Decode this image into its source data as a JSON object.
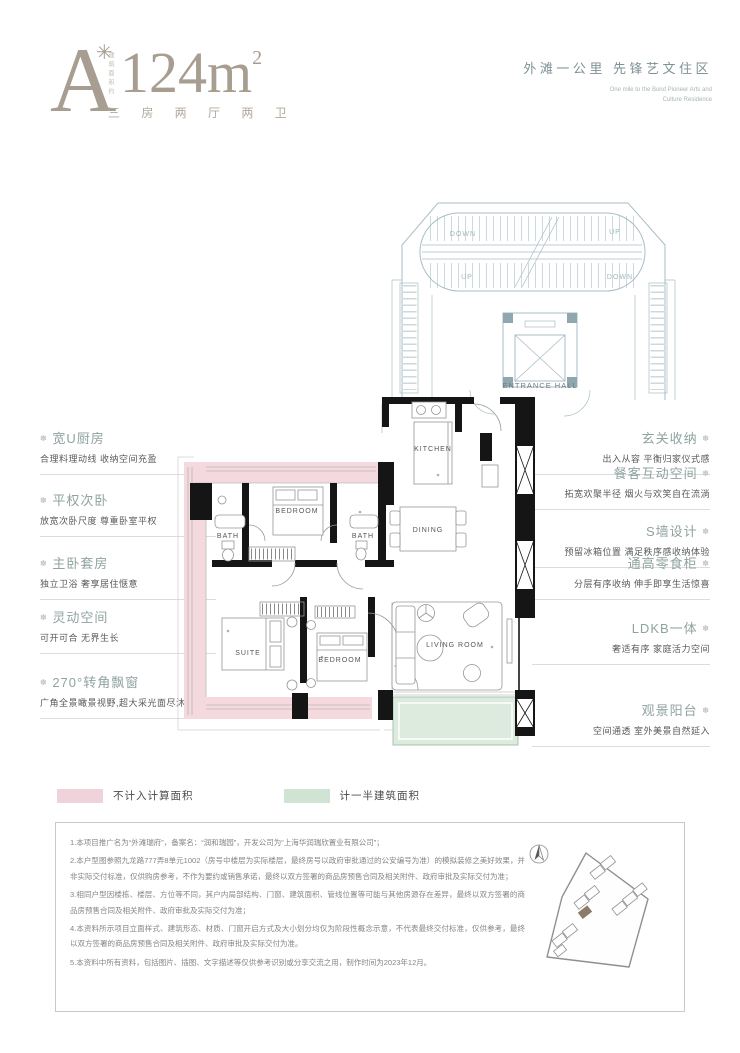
{
  "header": {
    "plan_letter": "A",
    "plan_star": "✳",
    "area_vertical_label": "建筑面积约",
    "area_value": "124m",
    "area_sup": "2",
    "layout_spec": "三 房 两 厅 两 卫",
    "tagline_cn": "外滩一公里  先锋艺文住区",
    "tagline_en_line1": "One mile to the Bund Pioneer Arts and",
    "tagline_en_line2": "Culture Residence"
  },
  "annotations": {
    "bullet": "✽",
    "left": [
      {
        "title": "宽U厨房",
        "desc": "合理料理动线 收纳空间充盈"
      },
      {
        "title": "平权次卧",
        "desc": "放宽次卧尺度 尊重卧室平权"
      },
      {
        "title": "主卧套房",
        "desc": "独立卫浴 奢享居住惬意"
      },
      {
        "title": "灵动空间",
        "desc": "可开可合 无界生长"
      },
      {
        "title": "270°转角飘窗",
        "desc": "广角全景瞰景视野,超大采光面尽沐阳光"
      }
    ],
    "right": [
      {
        "title": "玄关收纳",
        "desc": "出入从容 平衡归家仪式感"
      },
      {
        "title": "餐客互动空间",
        "desc": "拓宽欢聚半径 烟火与欢笑自在流淌"
      },
      {
        "title": "S墙设计",
        "desc": "预留冰箱位置 满足秩序感收纳体验"
      },
      {
        "title": "通高零食柜",
        "desc": "分层有序收纳 伸手即享生活惊喜"
      },
      {
        "title": "LDKB一体",
        "desc": "奢适有序 家庭活力空间"
      },
      {
        "title": "观景阳台",
        "desc": "空间通透 室外美景自然延入"
      }
    ]
  },
  "plan": {
    "rooms": {
      "kitchen": "KITCHEN",
      "bath": "BATH",
      "dining": "DINING",
      "bedroom": "BEDROOM",
      "suite": "SUITE",
      "living": "LIVING ROOM",
      "entrance_hall": "ENTRANCE HALL",
      "up": "UP",
      "down": "DOWN"
    },
    "colors": {
      "no_area_pink": "#f4d9de",
      "half_area_green": "#dcebdd",
      "core_blue": "#a9bec5",
      "wall_black": "#151515"
    }
  },
  "legend": {
    "items": [
      {
        "label": "不计入计算面积",
        "color": "#f0d3da"
      },
      {
        "label": "计一半建筑面积",
        "color": "#cfe4d3"
      }
    ]
  },
  "disclaimer": {
    "lines": [
      "1.本项目推广名为“外滩瑞府”，备案名：“润和瑞园”，开发公司为“上海华润瑞欣置业有限公司”；",
      "2.本户型图参照九龙路777弄8单元1002（房号中楼层为实际楼层，最终房号以政府审批通过的公安编号为准）的模拟装修之美好效果，并非实际交付标准，仅供购房参考，不作为要约或销售承诺，最终以双方签署的商品房预售合同及相关附件、政府审批及实际交付为准；",
      "3.相同户型因楼栋、楼层、方位等不同，其户内局部结构、门窗、建筑面积、管线位置等可能与其他房源存在差异，最终以双方签署的商品房预售合同及相关附件、政府审批及实际交付为准；",
      "4.本资料所示项目立面样式、建筑形态、材质、门窗开启方式及大小划分均仅为阶段性概念示意，不代表最终交付标准，仅供参考，最终以双方签署的商品房预售合同及相关附件、政府审批及实际交付为准。",
      "5.本资料中所有资料，包括图片、插图、文字描述等仅供参考识别或分享交流之用，制作时间为2023年12月。"
    ]
  }
}
